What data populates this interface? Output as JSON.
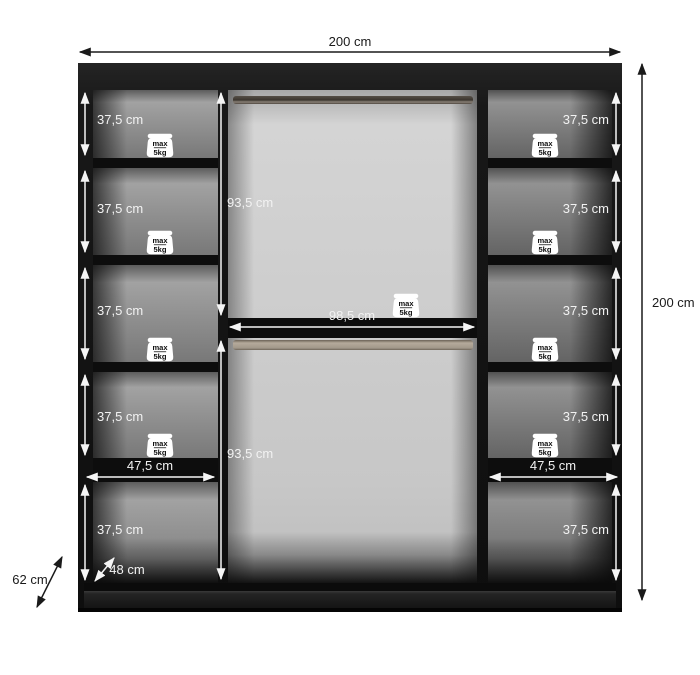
{
  "diagram": {
    "kind": "wardrobe-dimension-drawing",
    "overall": {
      "width": "200 cm",
      "height": "200 cm",
      "depth": "62 cm"
    },
    "interior": {
      "shelf_height": "37,5 cm",
      "shelf_width": "47,5 cm",
      "hanging_height": "93,5 cm",
      "hanging_width": "98,5 cm",
      "usable_depth": "48 cm",
      "shelf_compartments_left": 5,
      "shelf_compartments_right": 5,
      "hanging_rails": 2
    },
    "weight_limit": {
      "line1": "max",
      "line2": "5kg"
    },
    "colors": {
      "background": "#ffffff",
      "carcass_black": "#141414",
      "side_panel_gray": "#8f8f8f",
      "middle_panel_gray": "#c9c9c9",
      "rail_top": "#6b6259",
      "rail_bottom": "#b1a697",
      "dimension_dark": "#1a1a1a",
      "dimension_light": "#f2f2f2"
    }
  }
}
